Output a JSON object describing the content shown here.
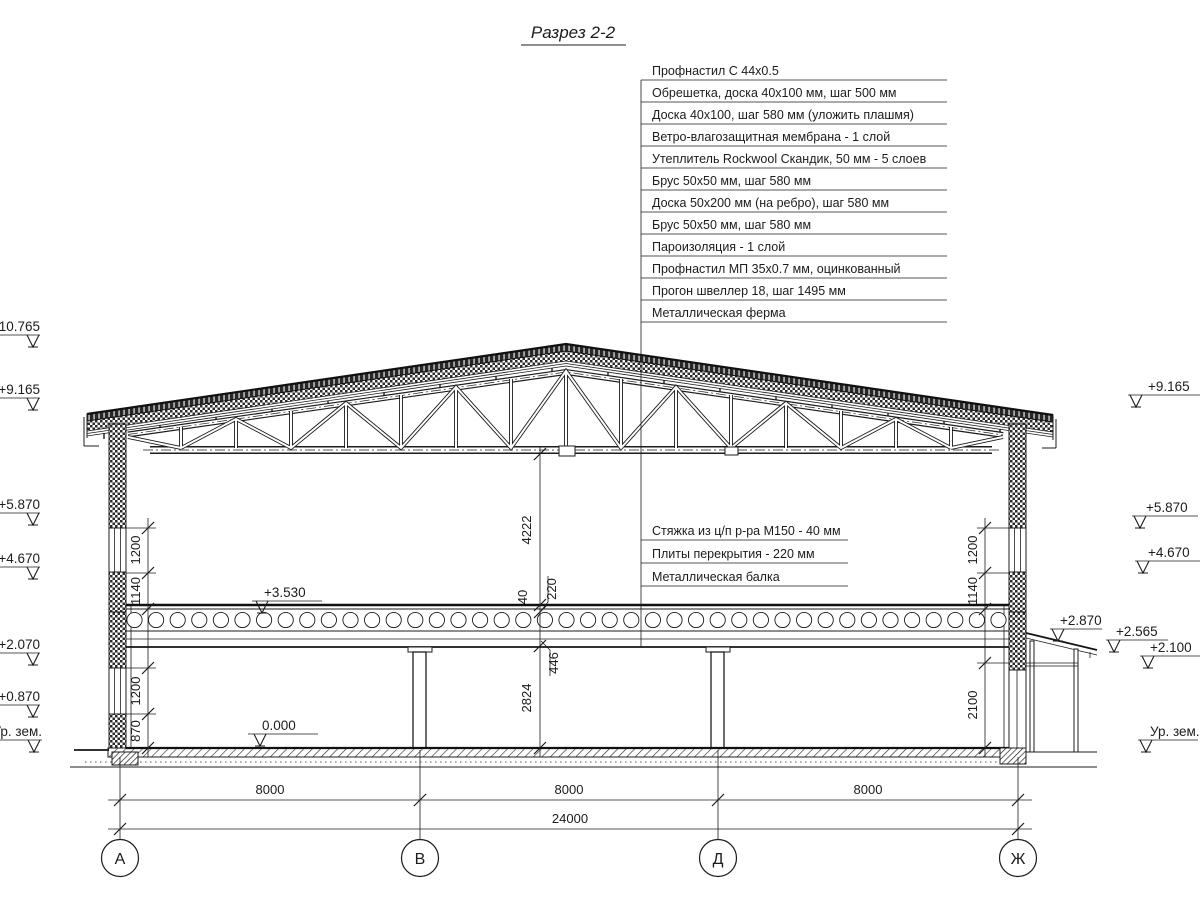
{
  "title": "Разрез 2-2",
  "roof_layers": [
    "Профнастил С 44х0.5",
    "Обрешетка, доска 40х100 мм, шаг 500 мм",
    "Доска 40х100, шаг 580 мм (уложить плашмя)",
    "Ветро-влагозащитная мембрана - 1 слой",
    "Утеплитель Rockwool Скандик, 50 мм - 5 слоев",
    "Брус 50х50 мм, шаг 580 мм",
    "Доска 50х200 мм (на ребро), шаг 580 мм",
    "Брус 50х50 мм, шаг 580 мм",
    "Пароизоляция - 1 слой",
    "Профнастил МП 35х0.7 мм, оцинкованный",
    "Прогон швеллер 18, шаг 1495 мм",
    "Металлическая ферма"
  ],
  "floor_layers": [
    "Стяжка из ц/п р-ра М150 - 40 мм",
    "Плиты перекрытия - 220 мм",
    "Металлическая балка"
  ],
  "elevations": {
    "left": [
      "+10.765",
      "+9.165",
      "+5.870",
      "+4.670",
      "+2.070",
      "+0.870"
    ],
    "left_ground": "Ур. зем.",
    "right": [
      "+9.165",
      "+5.870",
      "+4.670",
      "+2.870",
      "+2.565",
      "+2.100"
    ],
    "right_ground": "Ур. зем.",
    "internal_floor2": "+3.530",
    "internal_floor1": "0.000"
  },
  "dimensions": {
    "left_chain": [
      "1200",
      "1140",
      "1200",
      "870"
    ],
    "right_chain": [
      "1200",
      "1140",
      "2100"
    ],
    "center_chain": [
      "4222",
      "40",
      "220",
      "446",
      "2824"
    ],
    "spans": [
      "8000",
      "8000",
      "8000"
    ],
    "total": "24000"
  },
  "axes": [
    "А",
    "В",
    "Д",
    "Ж"
  ],
  "colors": {
    "line": "#1c1c1c",
    "background": "#ffffff"
  }
}
